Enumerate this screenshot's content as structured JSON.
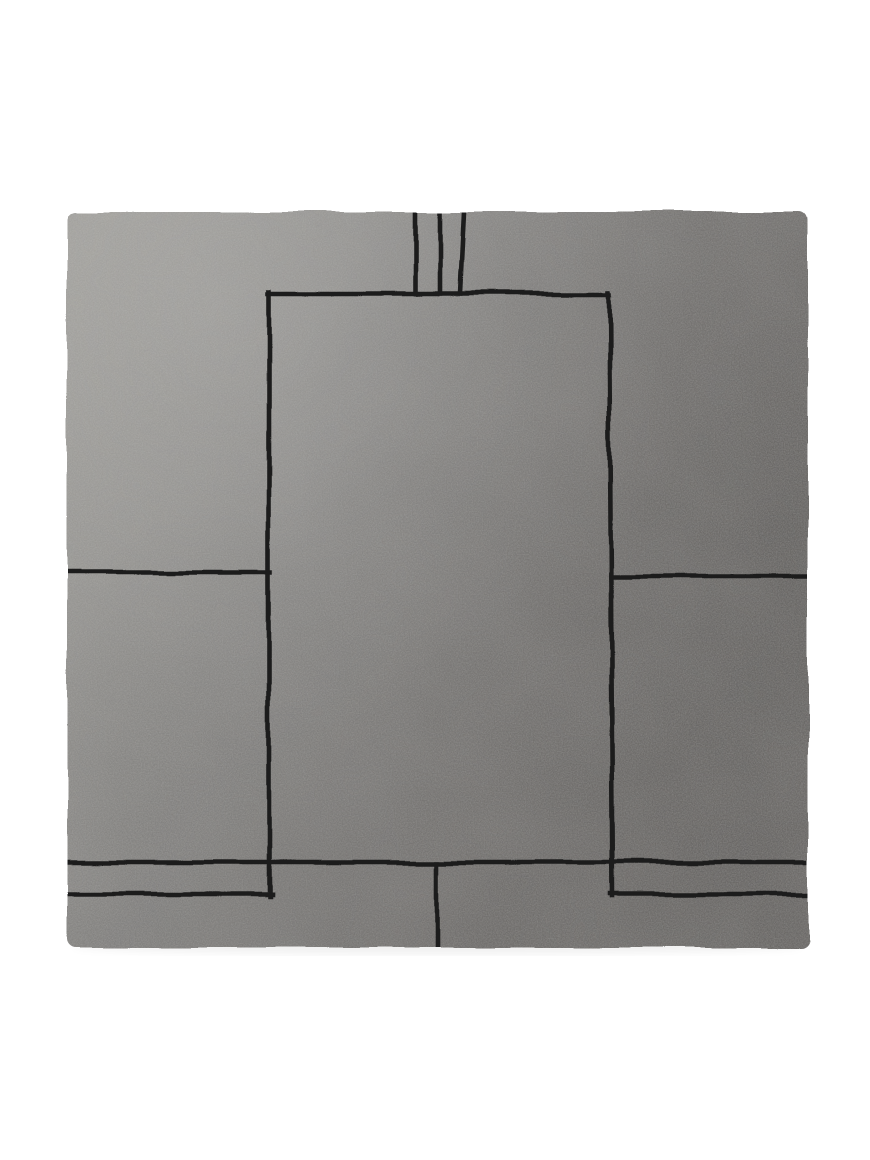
{
  "canvas": {
    "width": 870,
    "height": 1160,
    "background_color": "#ffffff"
  },
  "subject": {
    "label": "square gray hand-tufted rug with minimalist black line pattern, viewed flat from above on white background",
    "rug": {
      "x": 67,
      "y": 212,
      "width": 741,
      "height": 736,
      "corner_radius": 9,
      "edge_wobble": 8,
      "base_color_left": "#9c9b97",
      "base_color_mid1": "#888785",
      "base_color_mid2": "#7b7977",
      "base_color_right": "#706e6c",
      "highlight_color": "#ffffff",
      "shade_color": "#141414",
      "line_color": "#1d1d1d",
      "line_width": 4.6,
      "shadow_opacity": 0.06,
      "pattern_lines": [
        {
          "name": "top-stripe-left",
          "x1": 415,
          "y1": 212,
          "x2": 415,
          "y2": 294
        },
        {
          "name": "top-stripe-middle",
          "x1": 440,
          "y1": 212,
          "x2": 440,
          "y2": 294
        },
        {
          "name": "top-stripe-right",
          "x1": 464,
          "y1": 212,
          "x2": 460,
          "y2": 294
        },
        {
          "name": "inner-frame-top",
          "x1": 268,
          "y1": 294,
          "x2": 610,
          "y2": 294
        },
        {
          "name": "inner-frame-left",
          "x1": 269,
          "y1": 292,
          "x2": 269,
          "y2": 896
        },
        {
          "name": "inner-frame-right",
          "x1": 609,
          "y1": 292,
          "x2": 613,
          "y2": 896
        },
        {
          "name": "left-mid-rule",
          "x1": 67,
          "y1": 573,
          "x2": 271,
          "y2": 573
        },
        {
          "name": "right-mid-rule",
          "x1": 611,
          "y1": 576,
          "x2": 808,
          "y2": 576
        },
        {
          "name": "bottom-full-rule",
          "x1": 67,
          "y1": 862,
          "x2": 808,
          "y2": 862
        },
        {
          "name": "bottom-left-rule",
          "x1": 67,
          "y1": 894,
          "x2": 271,
          "y2": 894
        },
        {
          "name": "bottom-right-rule",
          "x1": 611,
          "y1": 894,
          "x2": 807,
          "y2": 894
        },
        {
          "name": "bottom-center-stripe",
          "x1": 437,
          "y1": 862,
          "x2": 437,
          "y2": 947
        }
      ]
    }
  }
}
